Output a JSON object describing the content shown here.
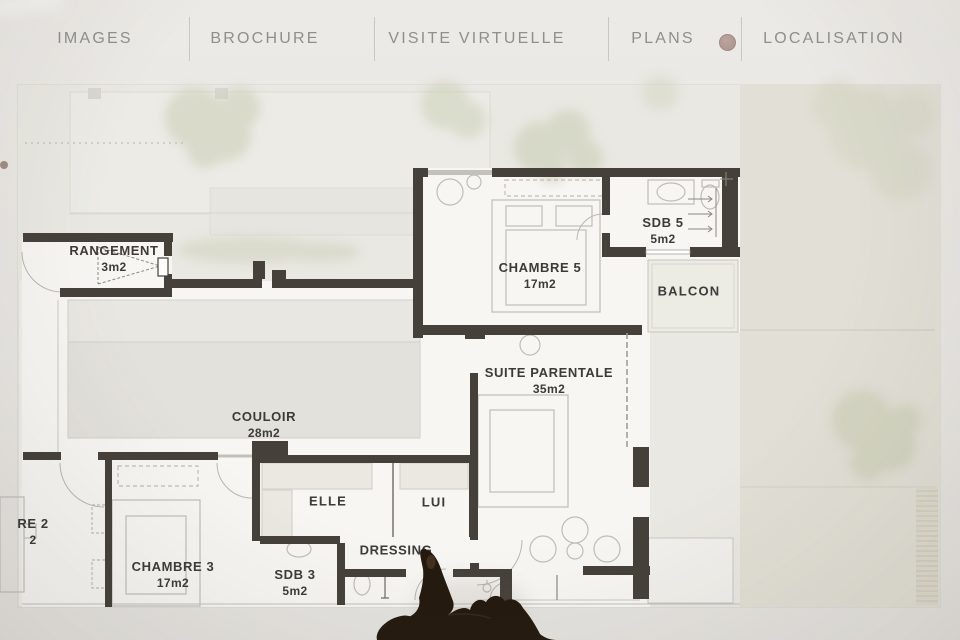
{
  "nav": {
    "tabs": [
      {
        "label": "IMAGES",
        "active": false
      },
      {
        "label": "BROCHURE",
        "active": false
      },
      {
        "label": "VISITE VIRTUELLE",
        "active": false
      },
      {
        "label": "PLANS",
        "active": true
      },
      {
        "label": "LOCALISATION",
        "active": false
      }
    ],
    "active_indicator": {
      "icon": "active-tab-dot",
      "color": "#b49a94"
    }
  },
  "plan": {
    "type": "apartment-floor-plan",
    "wall_color": "#45403a",
    "paper_color": "#efeee9",
    "rooms": [
      {
        "name": "RANGEMENT",
        "area": "3m2"
      },
      {
        "name": "CHAMBRE 5",
        "area": "17m2"
      },
      {
        "name": "SDB 5",
        "area": "5m2"
      },
      {
        "name": "BALCON",
        "area": ""
      },
      {
        "name": "SUITE PARENTALE",
        "area": "35m2"
      },
      {
        "name": "COULOIR",
        "area": "28m2"
      },
      {
        "name": "ELLE",
        "area": ""
      },
      {
        "name": "LUI",
        "area": ""
      },
      {
        "name": "DRESSING",
        "area": ""
      },
      {
        "name": "SDB 3",
        "area": "5m2"
      },
      {
        "name": "CHAMBRE 3",
        "area": "17m2"
      },
      {
        "name": "RE 2",
        "area": "2"
      }
    ]
  }
}
